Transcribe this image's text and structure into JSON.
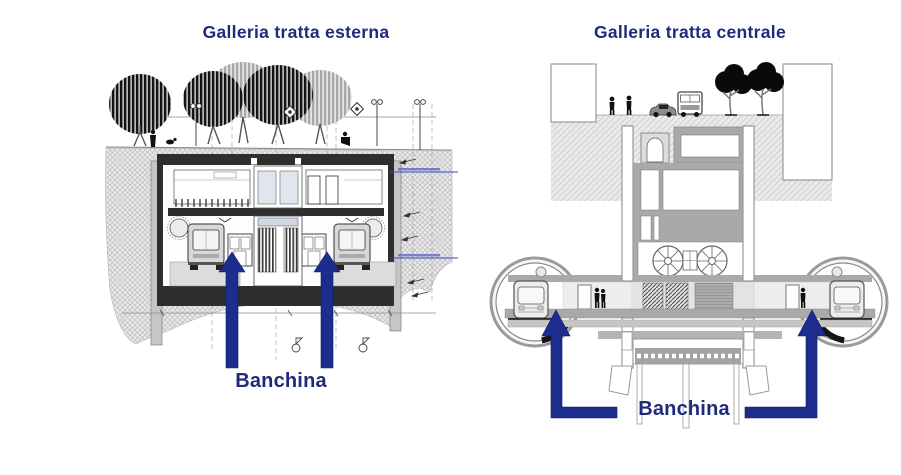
{
  "slide": {
    "background": "#ffffff",
    "accent_text_color": "#1e2a7c",
    "arrow_color": "#1c2d8f"
  },
  "panels": [
    {
      "id": "esterna",
      "title": "Galleria tratta esterna",
      "callout": "Banchina"
    },
    {
      "id": "centrale",
      "title": "Galleria tratta centrale",
      "callout": "Banchina"
    }
  ]
}
